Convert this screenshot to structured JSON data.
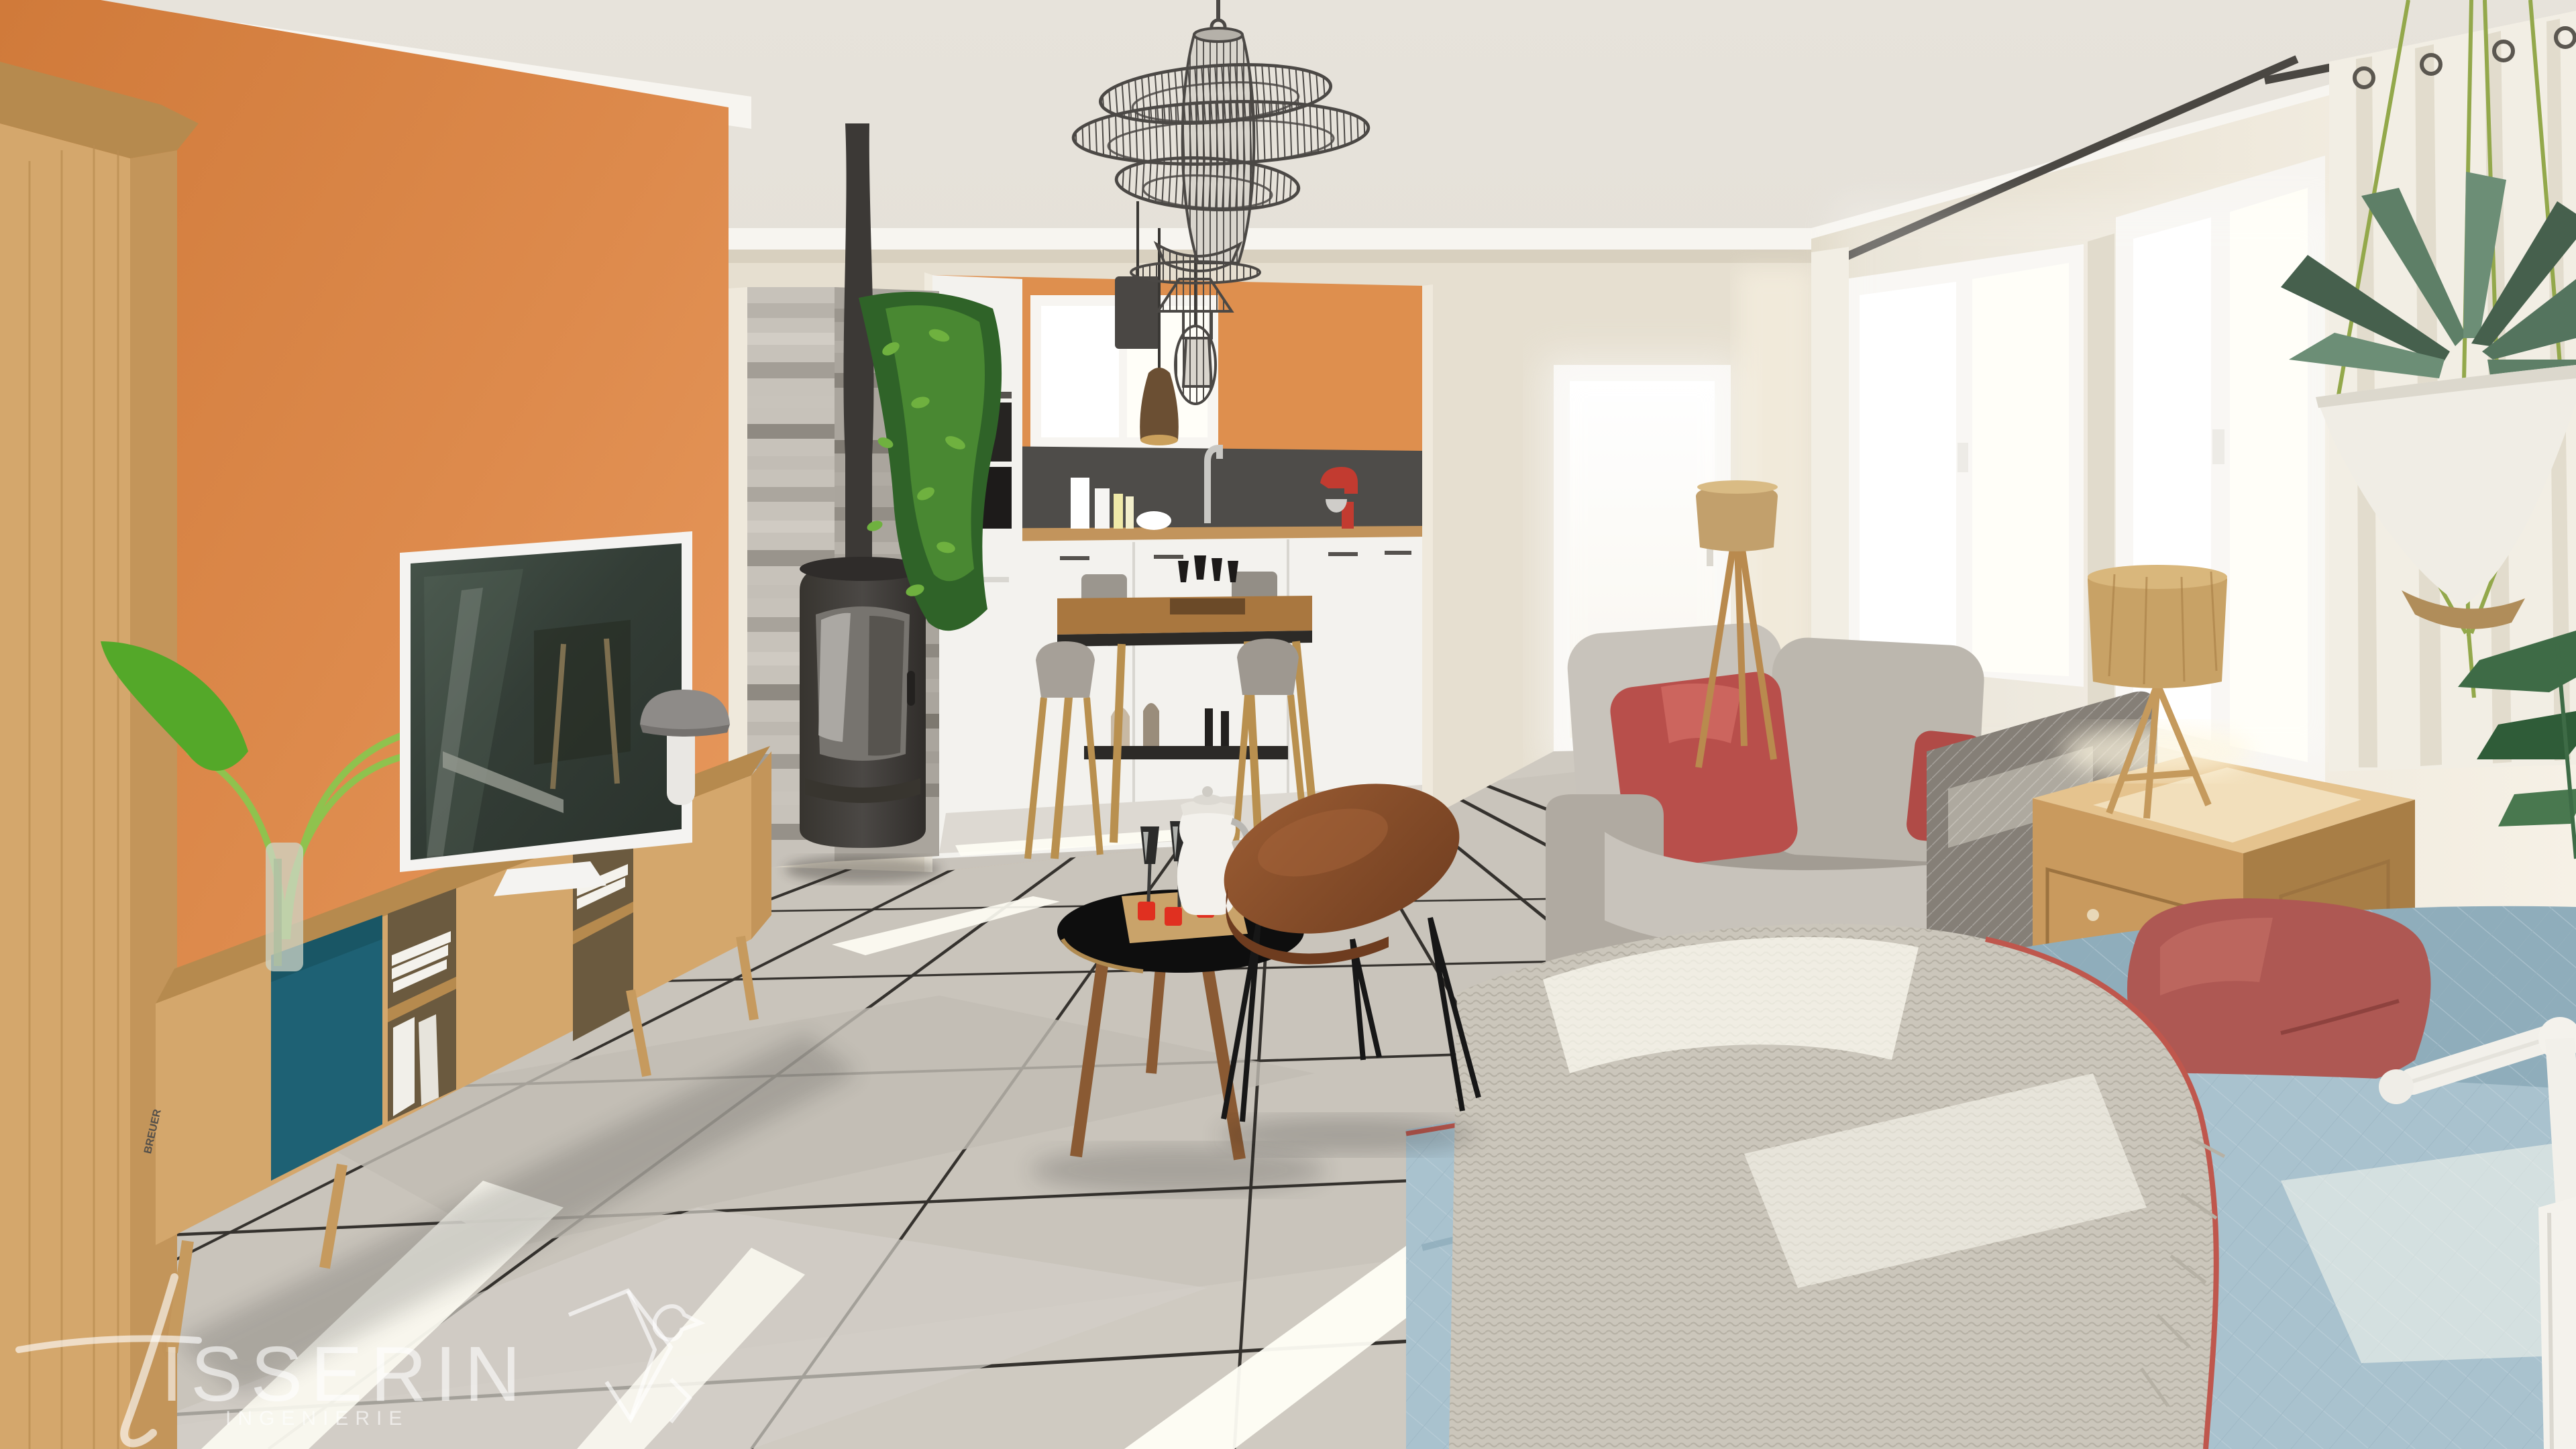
{
  "watermark": {
    "brand": "TISSERIN",
    "brand_display": "ISSERIN",
    "subtitle": "INGENIERIE"
  },
  "books": {
    "spine_title": "BREUER",
    "spine_subtitle": "New York"
  },
  "scene": {
    "type": "3d-interior-render",
    "rooms": [
      "living-room",
      "open-kitchen"
    ],
    "objects": [
      "wire-cage-chandelier",
      "pendant-lights",
      "orange-accent-wall",
      "oak-wardrobe",
      "tv-on-media-console",
      "teal-sliding-door-console",
      "mushroom-table-lamp",
      "glass-vase-plant",
      "wood-burning-stove",
      "stone-clad-pillar",
      "hanging-ivy",
      "kitchen-white-cabinets",
      "red-stand-mixer",
      "high-dining-table",
      "bar-stools",
      "grey-fabric-sofa",
      "red-cushions",
      "tripod-floor-lamp",
      "glass-patio-door",
      "black-tripod-coffee-table",
      "oval-hairpin-coffee-table",
      "coffee-pot-and-flutes",
      "wooden-chest-side-table",
      "wood-tripod-table-lamp",
      "blue-quilted-daybed",
      "knit-throw",
      "maroon-pillow",
      "double-casement-windows",
      "grommet-curtain",
      "hanging-agave-planter",
      "white-floor-lamp",
      "tiled-floor-with-sunlight"
    ]
  },
  "palette": {
    "ceiling": "#eae6df",
    "ceilingDark": "#dcd7ce",
    "crown": "#f7f5f0",
    "wallOrange": "#dd8a4c",
    "wallOrangeLight": "#e99c60",
    "wallOrangeDark": "#cf7a3b",
    "wallBeige": "#e6dfd0",
    "wallBeigeDark": "#d5ccba",
    "wallWhite": "#f2ede3",
    "kitchenOrange": "#de8f4e",
    "backsplash": "#4e4c49",
    "cabinet": "#f3f2ee",
    "cabinetShadow": "#dedcd5",
    "counter": "#c2945c",
    "floor": "#cfcac1",
    "floorLight": "#ddd9d2",
    "floorDark": "#b9b4ab",
    "grout": "#35322e",
    "sunlight": "#fffef5",
    "stone1": "#c7c2ba",
    "stone2": "#aaa59d",
    "stone3": "#918c84",
    "stone4": "#b7b2aa",
    "stove": "#454240",
    "stoveDark": "#2f2c2a",
    "stoveGlass": "#8b8986",
    "oak": "#d4a76c",
    "oakDark": "#b68a4e",
    "oakSide": "#c3955a",
    "teal": "#1e6174",
    "tvFrame": "#f4f3f1",
    "tvScreen": "#333d36",
    "tvScreenLight": "#50604f",
    "sofa": "#a29c93",
    "sofaLight": "#c8c3bb",
    "sofaDark": "#857f77",
    "cushionRed": "#b84f4b",
    "cushionCream": "#cfc9bc",
    "blue": "#a9c2ce",
    "blueDark": "#8fadbb",
    "pipingRed": "#bf574d",
    "throw": "#cbc6bb",
    "throwDark": "#b0aba0",
    "pillowRed": "#ae5853",
    "chest": "#c99a5e",
    "chestLight": "#dcb273",
    "chestDark": "#a87e46",
    "lampWood": "#c8a266",
    "lampShadeTop": "#d9b77c",
    "burlap": "#c2a06c",
    "wire": "#4b4845",
    "wireFill": "#d9d5cd",
    "ivy": "#2f6328",
    "ivyLight": "#4c8c33",
    "ivyBright": "#6fb13f",
    "leaf": "#54a829",
    "leafLight": "#7ccc43",
    "agave": "#5e7f67",
    "agaveDark": "#46604d",
    "planter": "#f0ede5",
    "cord": "#93a84b",
    "curtain": "#f2eee4",
    "curtainShade": "#e1dbcc",
    "frame": "#f7f5f1",
    "glow": "#ffffff",
    "rod": "#4a4742",
    "walnut": "#8a4f2b",
    "walnutDark": "#6e3c1f",
    "black": "#121212",
    "mushroom": "#8e8b88",
    "mushroomDark": "#74716e",
    "marble": "#e9e7e3",
    "metal": "#c9c8c6",
    "mixerRed": "#c23b30",
    "white": "#f6f4ef",
    "watermark": "rgba(255,255,255,0.55)"
  }
}
